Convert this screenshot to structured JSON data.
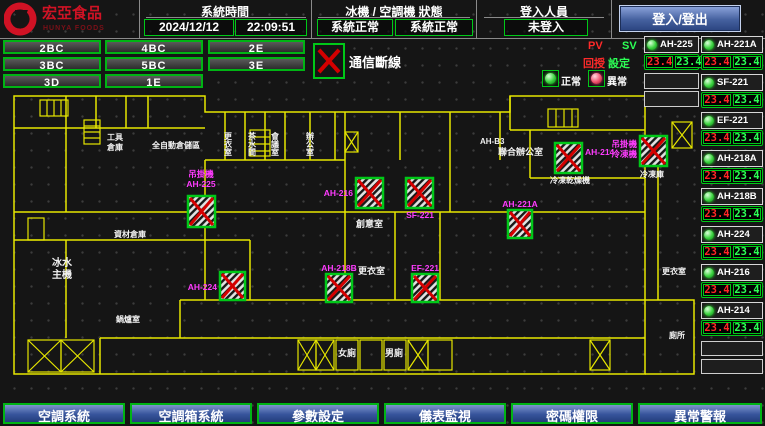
{
  "header": {
    "logo_title": "宏亞食品",
    "logo_subtitle": "HUNYA FOODS",
    "system_time_label": "系統時間",
    "date": "2024/12/12",
    "time": "22:09:51",
    "machine_status_label": "冰機 / 空調機 狀態",
    "chiller_status": "系統正常",
    "ahu_status": "系統正常",
    "login_label": "登入人員",
    "login_status": "未登入",
    "login_button": "登入/登出"
  },
  "floor_buttons": [
    "2BC",
    "4BC",
    "2E",
    "3BC",
    "5BC",
    "3E",
    "3D",
    "1E"
  ],
  "legend": {
    "comm_loss": "通信斷線",
    "pv": "PV",
    "sv": "SV",
    "feedback": "回授",
    "setpoint": "設定",
    "normal": "正常",
    "abnormal": "異常"
  },
  "unit_panel": {
    "units": [
      {
        "name": "AH-225",
        "pv": "23.4",
        "sv": "23.4"
      },
      {
        "name": "AH-221A",
        "pv": "23.4",
        "sv": "23.4"
      },
      {
        "name": "SF-221",
        "pv": "23.4",
        "sv": "23.4"
      },
      {
        "name": "EF-221",
        "pv": "23.4",
        "sv": "23.4"
      },
      {
        "name": "AH-218A",
        "pv": "23.4",
        "sv": "23.4"
      },
      {
        "name": "AH-218B",
        "pv": "23.4",
        "sv": "23.4"
      },
      {
        "name": "AH-224",
        "pv": "23.4",
        "sv": "23.4"
      },
      {
        "name": "AH-216",
        "pv": "23.4",
        "sv": "23.4"
      },
      {
        "name": "AH-214",
        "pv": "23.4",
        "sv": "23.4"
      }
    ]
  },
  "floorplan": {
    "devices": [
      {
        "label": "吊掛機",
        "label2": "AH-225"
      },
      {
        "label": "AH-224"
      },
      {
        "label": "AH-216"
      },
      {
        "label": "SF-221"
      },
      {
        "label": "AH-218B"
      },
      {
        "label": "EF-221"
      },
      {
        "label": "AH-221A"
      },
      {
        "label": "AH-214",
        "sublabel": "冷凍乾燥機"
      },
      {
        "label": "吊掛機",
        "label2": "冷凍機",
        "sublabel": "冷凍庫"
      }
    ],
    "rooms": [
      {
        "text": "AH-B3"
      },
      {
        "text": "聯合辦公室"
      },
      {
        "text": "創意室"
      },
      {
        "text": "更衣室"
      },
      {
        "text": "女廁"
      },
      {
        "text": "男廁"
      },
      {
        "text": "冰水"
      },
      {
        "text": "主機"
      },
      {
        "text": "資材倉庫"
      },
      {
        "text": "鍋爐室"
      },
      {
        "text": "工具"
      },
      {
        "text": "倉庫"
      },
      {
        "text": "全自動倉儲區"
      },
      {
        "text": "更衣室"
      },
      {
        "text": "廁所"
      },
      {
        "text": "更衣室"
      },
      {
        "text": "茶水間"
      },
      {
        "text": "會議室"
      },
      {
        "text": "辦公室"
      }
    ]
  },
  "footer_buttons": [
    "空調系統",
    "空調箱系統",
    "參數設定",
    "儀表監視",
    "密碼權限",
    "異常警報"
  ],
  "colors": {
    "accent_green": "#00c818",
    "alarm_red": "#d40000",
    "label_magenta": "#ff3cff",
    "value_red": "#ff2626",
    "value_green": "#2cff55",
    "button_blue": "#37549c",
    "wall_yellow": "#e6e600"
  }
}
